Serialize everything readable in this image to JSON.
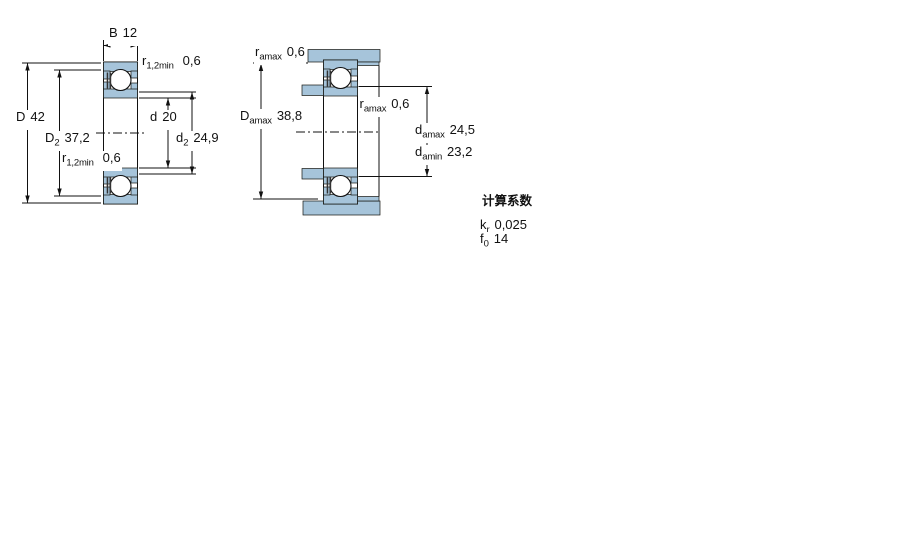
{
  "colors": {
    "section_fill": "#a6c4da",
    "line": "#111111",
    "background": "#ffffff"
  },
  "drawing1": {
    "width_dim": {
      "label": "B",
      "value": "12"
    },
    "chamfer_top": {
      "label": "r",
      "sub": "1,2min",
      "value": "0,6"
    },
    "outer_dia": {
      "label": "D",
      "value": "42"
    },
    "recess_dia": {
      "label": "D",
      "sub": "2",
      "value": "37,2"
    },
    "chamfer_bottom": {
      "label": "r",
      "sub": "1,2min",
      "value": "0,6"
    },
    "bore_dia": {
      "label": "d",
      "value": "20"
    },
    "shoulder_dia": {
      "label": "d",
      "sub": "2",
      "value": "24,9"
    }
  },
  "drawing2": {
    "fillet_top": {
      "label": "r",
      "sub": "amax",
      "value": "0,6"
    },
    "housing_abutment_dia": {
      "label": "D",
      "sub": "amax",
      "value": "38,8"
    },
    "fillet_mid": {
      "label": "r",
      "sub": "amax",
      "value": "0,6"
    },
    "shaft_abutment_dia_max": {
      "label": "d",
      "sub": "amax",
      "value": "24,5"
    },
    "shaft_abutment_dia_min": {
      "label": "d",
      "sub": "amin",
      "value": "23,2"
    }
  },
  "calculation_factors": {
    "title": "计算系数",
    "kr": {
      "label": "k",
      "sub": "r",
      "value": "0,025"
    },
    "f0": {
      "label": "f",
      "sub": "0",
      "value": "14"
    }
  }
}
